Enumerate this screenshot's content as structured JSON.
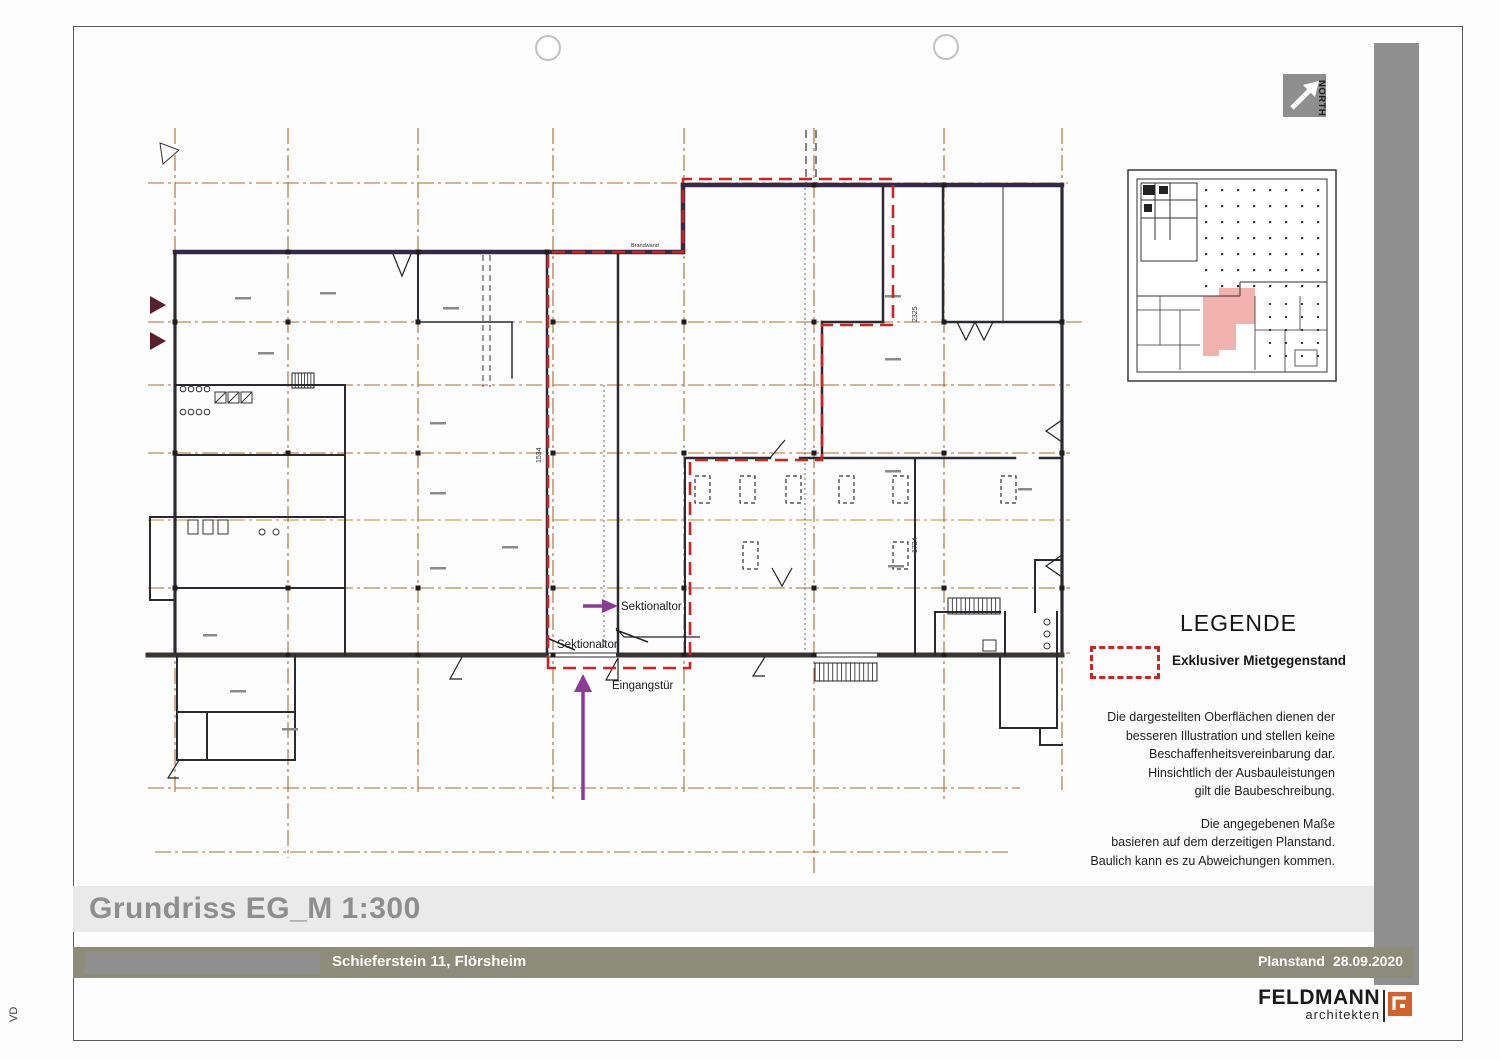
{
  "sheet": {
    "side_label": "VD"
  },
  "north": {
    "label": "NORTH"
  },
  "legend": {
    "title": "LEGENDE",
    "item_label": "Exklusiver Mietgegenstand",
    "swatch_color": "#cc2522"
  },
  "disclaimer": {
    "para1_lines": [
      "Die dargestellten Oberflächen dienen der",
      "besseren Illustration und stellen keine",
      "Beschaffenheitsvereinbarung dar.",
      "Hinsichtlich der Ausbauleistungen",
      "gilt die Baubeschreibung."
    ],
    "para2_lines": [
      "Die angegebenen Maße",
      "basieren auf dem derzeitigen Planstand.",
      "Baulich kann es zu Abweichungen kommen."
    ]
  },
  "titleblock": {
    "drawing_title": "Grundriss EG_M 1:300",
    "project": "Schieferstein 11, Flörsheim",
    "planstand_label": "Planstand",
    "planstand_date": "28.09.2020"
  },
  "logo": {
    "name": "FELDMANN",
    "sub": "architekten"
  },
  "plan": {
    "annotations": {
      "sektionaltor": "Sektionaltor",
      "eingangstuer": "Eingangstür",
      "brandwand": "Brandwand",
      "dim_1534": "1534",
      "dim_2325": "2325",
      "dim_1724": "1724"
    },
    "colors": {
      "grid": "#ad6a2e",
      "wall": "#2b2a33",
      "wall_dark": "#35294a",
      "boundary_red": "#cc2522",
      "arrow_purple": "#8b3a96",
      "highlight_pink": "#f2b3ae"
    }
  }
}
